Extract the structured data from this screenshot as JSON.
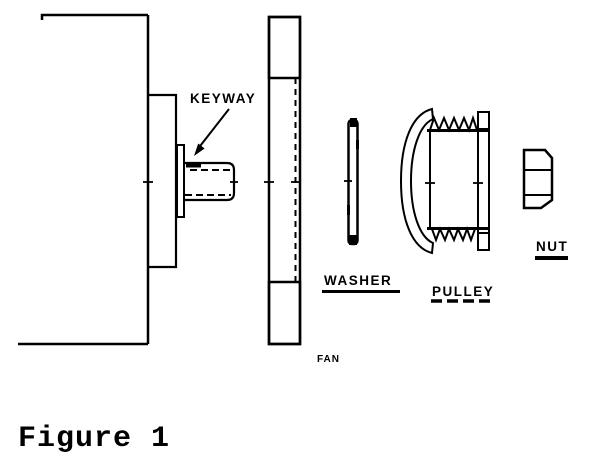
{
  "figure": {
    "caption": "Figure 1"
  },
  "labels": {
    "keyway": "KEYWAY",
    "washer": "WASHER",
    "fan": "FAN",
    "pulley": "PULLEY",
    "nut": "NUT"
  },
  "colors": {
    "ink": "#000000",
    "paper": "#ffffff"
  }
}
